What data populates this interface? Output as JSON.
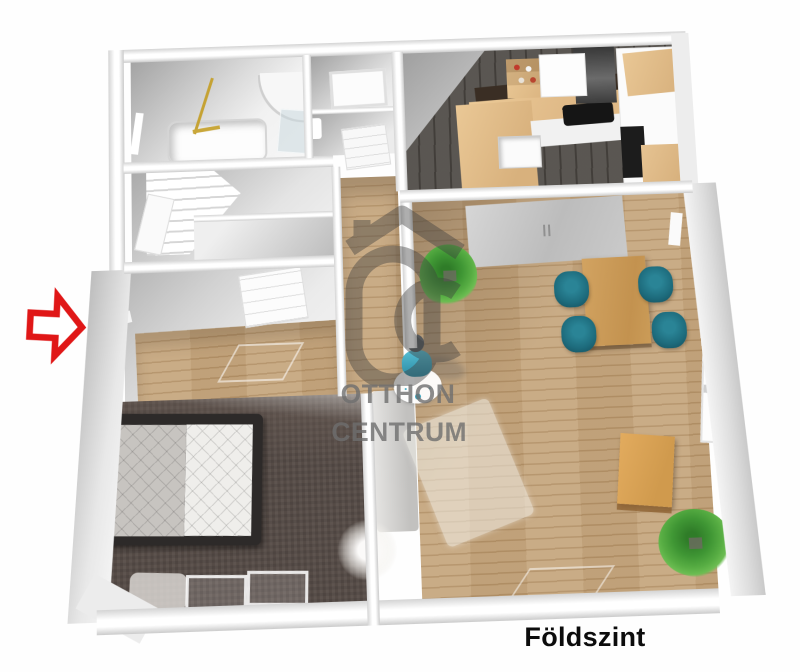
{
  "page": {
    "background_color": "#ffffff",
    "image_type": "3d-floor-plan-rendering"
  },
  "caption": {
    "floor_label": "Földszint"
  },
  "watermark": {
    "brand_line1": "OTTHON",
    "brand_line2": "CENTRUM",
    "logo": "otthon-centrum-house-logo",
    "color_hex": "#6f6f6f"
  },
  "entrance": {
    "icon": "entrance-arrow-icon",
    "color_hex": "#e01717",
    "direction": "right"
  },
  "palette": {
    "wood_floor": "#c2a176",
    "kitchen_floor": "#504c47",
    "bedroom_carpet": "#554b46",
    "wall_white": "#ffffff",
    "wall_shadow_gray": "#a8a8a8",
    "chair_teal": "#1d6b7c",
    "plant_green": "#4aa43e",
    "table_wood": "#cf9f58",
    "person_marker_teal": "#38a8bf",
    "counter_backsplash": "#3a2e24"
  },
  "rooms": [
    {
      "name": "bathroom",
      "objects": [
        "bathtub",
        "gold-shower-fixture",
        "curved-shower",
        "window"
      ]
    },
    {
      "name": "wc",
      "objects": [
        "window-panel",
        "washbasin",
        "door"
      ]
    },
    {
      "name": "kitchen",
      "objects": [
        "l-shaped-counter",
        "cooktop",
        "range-hood",
        "sink",
        "open-shelf",
        "tall-cabinet-with-oven"
      ]
    },
    {
      "name": "staircase-room",
      "objects": [
        "staircase",
        "door"
      ]
    },
    {
      "name": "entry-hall",
      "objects": [
        "interior-door",
        "doormat",
        "entrance-arrow"
      ]
    },
    {
      "name": "living-dining-room",
      "objects": [
        "sliding-wardrobe",
        "dining-table",
        "dining-chairs-x4",
        "area-rug",
        "coffee-table",
        "potted-plant-x2",
        "gray-bench",
        "window",
        "person-marker"
      ]
    },
    {
      "name": "bedroom",
      "objects": [
        "double-bed",
        "dried-white-plant",
        "small-rug",
        "low-windows"
      ]
    }
  ]
}
